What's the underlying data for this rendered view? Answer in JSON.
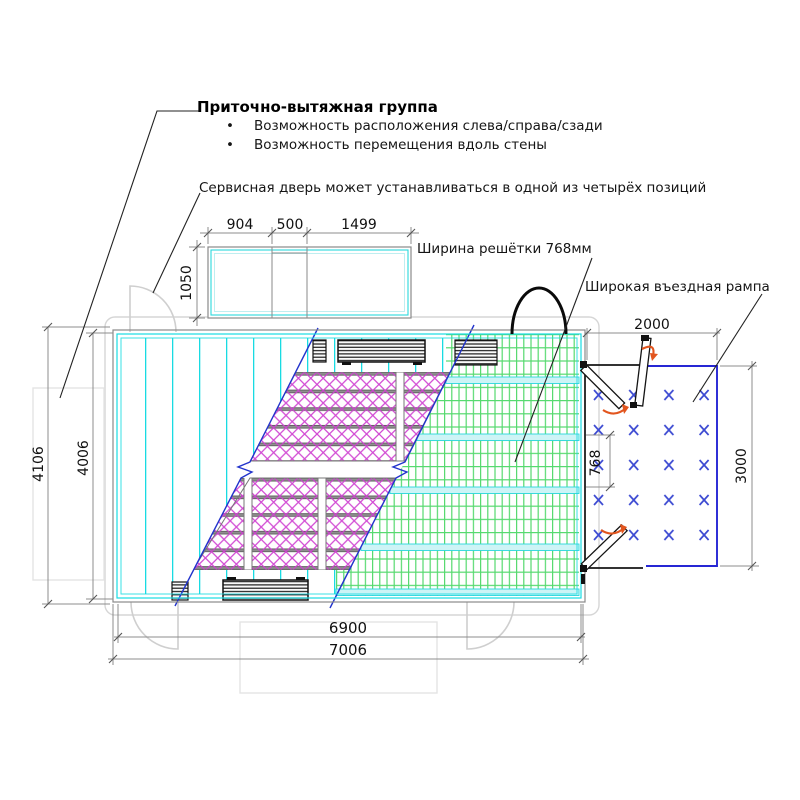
{
  "annotations": {
    "supply_group_title": "Приточно-вытяжная группа",
    "bullet_1": "Возможность расположения слева/справа/сзади",
    "bullet_2": "Возможность перемещения вдоль стены",
    "service_door_note": "Сервисная дверь может устанавливаться в одной из четырёх позиций",
    "grille_width_note": "Ширина решётки 768мм",
    "ramp_note": "Широкая въездная рампа",
    "bullet_char": "•"
  },
  "dimensions": {
    "ahu_top": {
      "left": "904",
      "middle": "500",
      "right": "1499",
      "height": "1050"
    },
    "plan": {
      "outer_height": "4106",
      "inner_height": "4006",
      "inner_length": "6900",
      "outer_length": "7006"
    },
    "ramp": {
      "width": "2000",
      "depth": "3000",
      "grille_width": "768"
    }
  },
  "colors": {
    "cyan_floor": "#18dbe2",
    "green_grille": "#55d96e",
    "magenta_insulation": "#cf3fd1",
    "section_line_blue": "#2233cc",
    "ramp_border_blue": "#2626d4",
    "ramp_cross_blue": "#3c4ad2",
    "rotation_arrow_red": "#e2551e",
    "dimension_gray": "#808080",
    "ghost_gray": "#cfcfcf"
  }
}
